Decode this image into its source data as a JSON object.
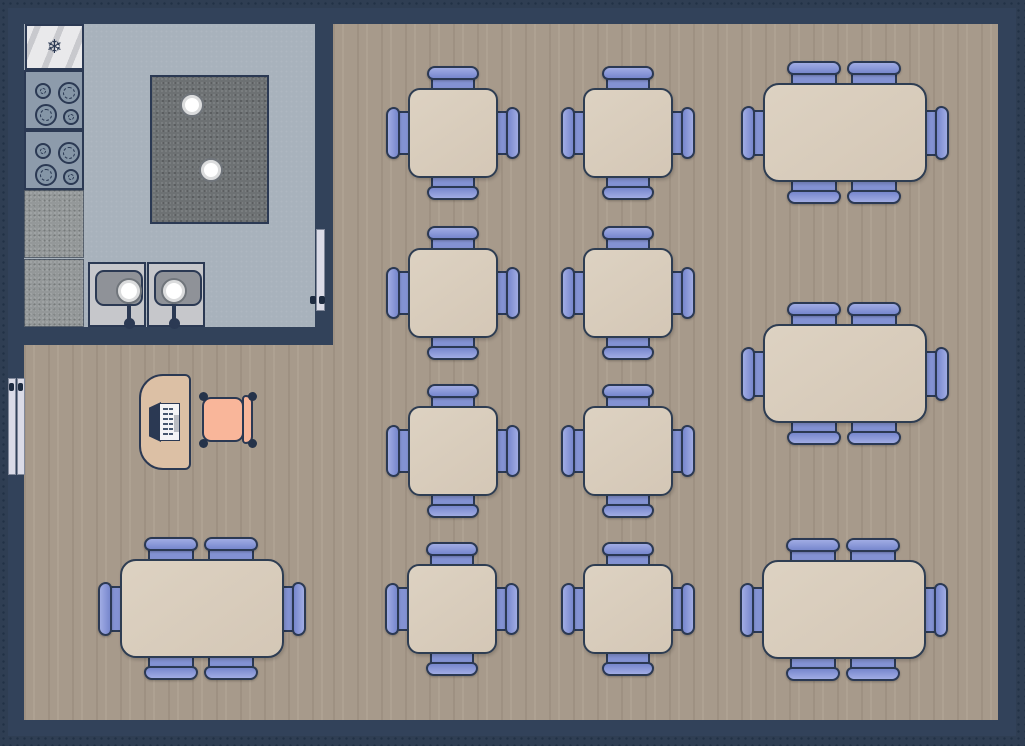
{
  "diagram": {
    "type": "restaurant-floor-plan"
  },
  "colors": {
    "canvas_bg": "#2f3e53",
    "grid_dot": "#223146",
    "wall": "#32425a",
    "wood_floor": "#a79a8b",
    "kitchen_floor": "#a8b2bc",
    "island_granite": "#6d7173",
    "counter_granite": "#949899",
    "sink_counter": "#c6c7cb",
    "sink_basin": "#8f9298",
    "table_top": "#d9ccbc",
    "outline": "#2b3953",
    "chair_blue": "#8392d3",
    "chair_blue_light": "#a0ace4",
    "host_chair_salmon": "#f9b69a",
    "desk_tan": "#dcc0a5",
    "door_panel": "#dadbe7",
    "fridge_white": "#e9e9eb",
    "bowl_white": "#ffffff"
  },
  "building": {
    "x": 8,
    "y": 8,
    "w": 1008,
    "h": 728
  },
  "rooms": {
    "kitchen_floor": {
      "x": 24,
      "y": 24,
      "w": 291,
      "h": 303
    },
    "dining_floor_main": {
      "x": 333,
      "y": 24,
      "w": 665,
      "h": 696
    },
    "dining_floor_left": {
      "x": 24,
      "y": 345,
      "w": 309,
      "h": 375
    }
  },
  "doors": {
    "kitchen_door": {
      "panel": {
        "x": 316,
        "y": 229,
        "w": 9,
        "h": 82
      },
      "handles": [
        {
          "x": 310,
          "y": 296,
          "w": 6,
          "h": 8
        },
        {
          "x": 319,
          "y": 296,
          "w": 6,
          "h": 8
        }
      ]
    },
    "entry_double_door": {
      "panels": [
        {
          "x": 8,
          "y": 378,
          "w": 8,
          "h": 97
        },
        {
          "x": 17,
          "y": 378,
          "w": 8,
          "h": 97
        }
      ],
      "handles": [
        {
          "x": 9,
          "y": 383,
          "w": 5,
          "h": 8
        },
        {
          "x": 18,
          "y": 383,
          "w": 5,
          "h": 8
        }
      ]
    }
  },
  "kitchen": {
    "fridge": {
      "x": 25,
      "y": 24,
      "w": 59,
      "h": 46,
      "icon": "snowflake-icon",
      "glyph": "❄"
    },
    "stoves": [
      {
        "x": 24,
        "y": 70,
        "w": 60,
        "h": 60
      },
      {
        "x": 24,
        "y": 130,
        "w": 60,
        "h": 60
      }
    ],
    "burner_layout": [
      {
        "cx": 17,
        "cy": 19,
        "r": 8
      },
      {
        "cx": 43,
        "cy": 21,
        "r": 11
      },
      {
        "cx": 20,
        "cy": 43,
        "r": 11
      },
      {
        "cx": 45,
        "cy": 45,
        "r": 8
      }
    ],
    "counters": [
      {
        "x": 24,
        "y": 190,
        "w": 60,
        "h": 68
      },
      {
        "x": 24,
        "y": 259,
        "w": 60,
        "h": 68
      }
    ],
    "island": {
      "x": 150,
      "y": 75,
      "w": 119,
      "h": 149,
      "bowls": [
        {
          "cx": 40,
          "cy": 28,
          "r": 12
        },
        {
          "cx": 59,
          "cy": 93,
          "r": 12
        }
      ]
    },
    "sinks": [
      {
        "x": 88,
        "y": 262,
        "w": 58,
        "h": 65,
        "basin": {
          "x": 5,
          "y": 6,
          "w": 48,
          "h": 36
        },
        "bowl": {
          "cx": 39,
          "cy": 27,
          "r": 13
        }
      },
      {
        "x": 147,
        "y": 262,
        "w": 58,
        "h": 65,
        "basin": {
          "x": 5,
          "y": 6,
          "w": 48,
          "h": 36
        },
        "bowl": {
          "cx": 25,
          "cy": 27,
          "r": 13
        }
      }
    ]
  },
  "host_station": {
    "desk": {
      "x": 139,
      "y": 374,
      "w": 52,
      "h": 96
    },
    "register": {
      "x": 149,
      "y": 401,
      "w": 31,
      "h": 42
    },
    "chair": {
      "x": 198,
      "y": 391,
      "w": 60,
      "h": 58
    }
  },
  "tables": {
    "square_spec": {
      "w": 90,
      "h": 90,
      "radius": 12,
      "chair_breadth": 46,
      "chair_depth": 36,
      "seats": 4
    },
    "rect_spec": {
      "w": 164,
      "h": 99,
      "radius": 16,
      "chair_breadth": 48,
      "chair_depth": 36,
      "seats": 6,
      "top_offsets": [
        51,
        111
      ]
    },
    "items": [
      {
        "id": "t1",
        "shape": "square",
        "x": 408,
        "y": 88
      },
      {
        "id": "t2",
        "shape": "square",
        "x": 583,
        "y": 88
      },
      {
        "id": "t3",
        "shape": "square",
        "x": 408,
        "y": 248
      },
      {
        "id": "t4",
        "shape": "square",
        "x": 583,
        "y": 248
      },
      {
        "id": "t5",
        "shape": "square",
        "x": 408,
        "y": 406
      },
      {
        "id": "t6",
        "shape": "square",
        "x": 583,
        "y": 406
      },
      {
        "id": "t7",
        "shape": "square",
        "x": 407,
        "y": 564
      },
      {
        "id": "t8",
        "shape": "square",
        "x": 583,
        "y": 564
      },
      {
        "id": "t9",
        "shape": "rect",
        "x": 763,
        "y": 83
      },
      {
        "id": "t10",
        "shape": "rect",
        "x": 763,
        "y": 324
      },
      {
        "id": "t11",
        "shape": "rect",
        "x": 762,
        "y": 560
      },
      {
        "id": "t12",
        "shape": "rect",
        "x": 120,
        "y": 559
      }
    ]
  }
}
